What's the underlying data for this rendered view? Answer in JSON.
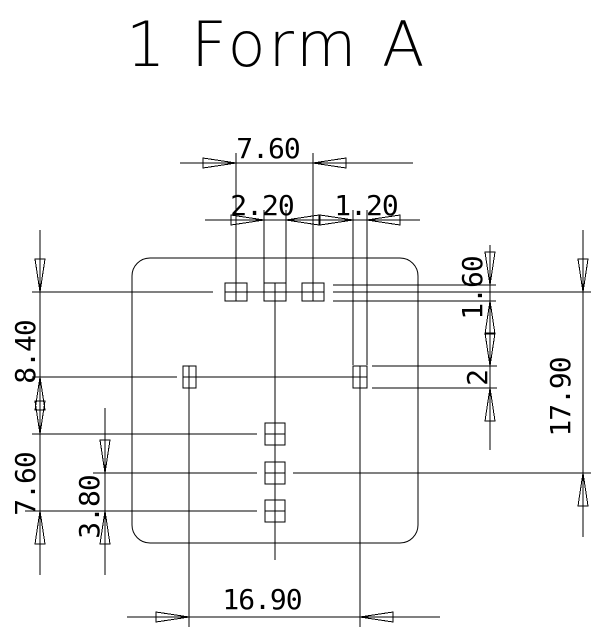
{
  "title": "1 Form A",
  "colors": {
    "line": "#000000",
    "background": "#ffffff"
  },
  "dims": {
    "top_pad_span": "7.60",
    "top_pad_width": "2.20",
    "side_pad_width": "1.20",
    "top_pad_height": "1.60",
    "top_to_side_row": "8.40",
    "side_pad_height": "2",
    "overall_vertical": "17.90",
    "center_pad_span": "7.60",
    "center_pad_half_span": "3.80",
    "side_pad_span": "16.90"
  }
}
